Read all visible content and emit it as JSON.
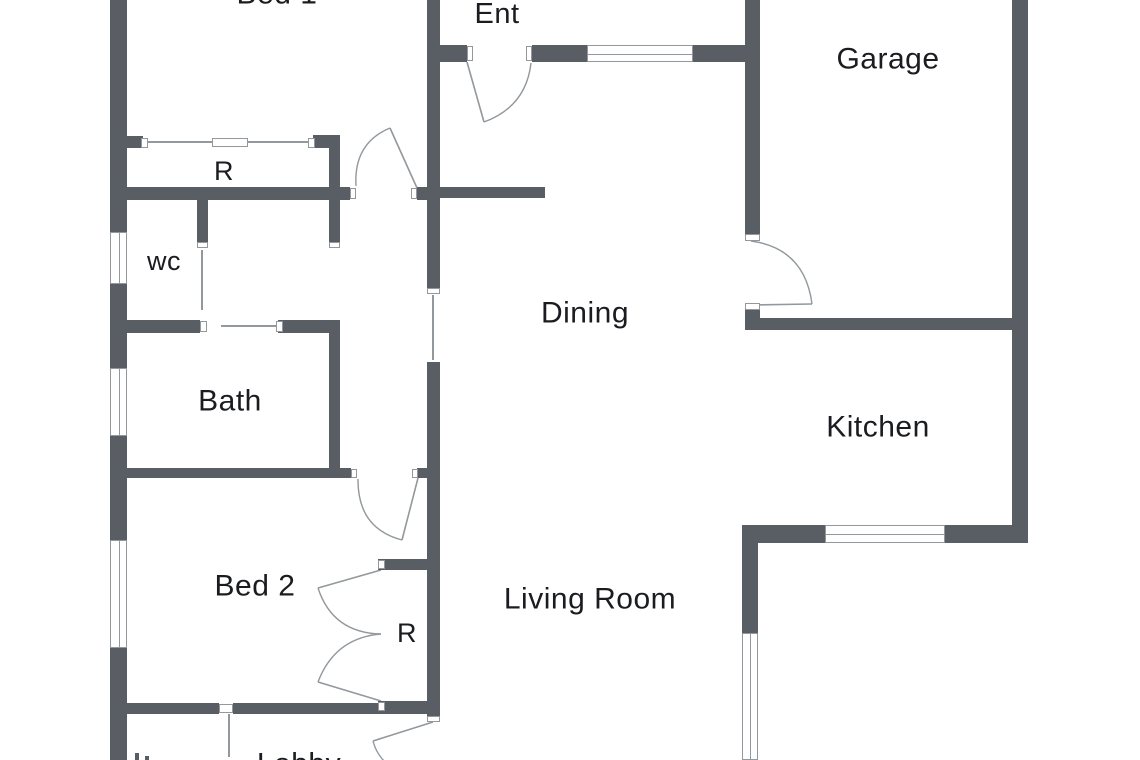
{
  "meta": {
    "type": "floor-plan",
    "description": "Single storey house floor plan"
  },
  "colors": {
    "wall": "#585e64",
    "line": "#92989c",
    "text": "#1b1c20",
    "bg": "#ffffff",
    "window_fill": "#ffffff"
  },
  "labels": [
    {
      "id": "bed1",
      "text": "Bed 1",
      "x": 277,
      "y": -6,
      "size": 30
    },
    {
      "id": "ent",
      "text": "Ent",
      "x": 497,
      "y": 15,
      "size": 29
    },
    {
      "id": "garage",
      "text": "Garage",
      "x": 888,
      "y": 59,
      "size": 30
    },
    {
      "id": "closet-r-top",
      "text": "R",
      "x": 224,
      "y": 172,
      "size": 27
    },
    {
      "id": "wc",
      "text": "wc",
      "x": 164,
      "y": 262,
      "size": 27
    },
    {
      "id": "dining",
      "text": "Dining",
      "x": 585,
      "y": 313,
      "size": 30
    },
    {
      "id": "bath",
      "text": "Bath",
      "x": 230,
      "y": 401,
      "size": 30
    },
    {
      "id": "kitchen",
      "text": "Kitchen",
      "x": 878,
      "y": 427,
      "size": 30
    },
    {
      "id": "bed2",
      "text": "Bed 2",
      "x": 255,
      "y": 586,
      "size": 30
    },
    {
      "id": "closet-r-bed2",
      "text": "R",
      "x": 407,
      "y": 634,
      "size": 27
    },
    {
      "id": "living-room",
      "text": "Living Room",
      "x": 590,
      "y": 599,
      "size": 30
    },
    {
      "id": "lobby",
      "text": "Lobby",
      "x": 299,
      "y": 764,
      "size": 30
    }
  ],
  "walls": [
    [
      110,
      0,
      17,
      232
    ],
    [
      110,
      284,
      17,
      84
    ],
    [
      110,
      436,
      17,
      104
    ],
    [
      110,
      648,
      17,
      112
    ],
    [
      427,
      0,
      13,
      290
    ],
    [
      427,
      362,
      13,
      356
    ],
    [
      440,
      45,
      27,
      17
    ],
    [
      532,
      45,
      55,
      17
    ],
    [
      693,
      45,
      52,
      17
    ],
    [
      745,
      0,
      15,
      241
    ],
    [
      745,
      303,
      15,
      27
    ],
    [
      745,
      318,
      267,
      12
    ],
    [
      1012,
      0,
      16,
      543
    ],
    [
      110,
      187,
      240,
      13
    ],
    [
      417,
      187,
      10,
      13
    ],
    [
      440,
      187,
      105,
      11
    ],
    [
      197,
      193,
      11,
      50
    ],
    [
      329,
      135,
      11,
      108
    ],
    [
      313,
      135,
      27,
      13
    ],
    [
      127,
      136,
      16,
      12
    ],
    [
      110,
      320,
      90,
      13
    ],
    [
      278,
      320,
      62,
      13
    ],
    [
      329,
      333,
      11,
      135
    ],
    [
      110,
      468,
      241,
      10
    ],
    [
      417,
      468,
      11,
      10
    ],
    [
      110,
      703,
      109,
      11
    ],
    [
      233,
      703,
      207,
      11
    ],
    [
      378,
      559,
      62,
      11
    ],
    [
      378,
      701,
      62,
      11
    ],
    [
      742,
      525,
      83,
      18
    ],
    [
      945,
      525,
      83,
      18
    ],
    [
      742,
      525,
      16,
      108
    ]
  ],
  "caps": [
    [
      350,
      188,
      6,
      11
    ],
    [
      411,
      188,
      6,
      11
    ],
    [
      467,
      46,
      6,
      15
    ],
    [
      526,
      46,
      6,
      15
    ],
    [
      745,
      234,
      15,
      7
    ],
    [
      745,
      303,
      15,
      7
    ],
    [
      351,
      469,
      6,
      9
    ],
    [
      412,
      469,
      6,
      9
    ],
    [
      427,
      288,
      13,
      6
    ],
    [
      427,
      716,
      13,
      6
    ],
    [
      378,
      560,
      7,
      9
    ],
    [
      378,
      702,
      7,
      9
    ],
    [
      219,
      704,
      14,
      9
    ],
    [
      197,
      242,
      11,
      6
    ],
    [
      329,
      242,
      11,
      6
    ],
    [
      200,
      321,
      7,
      11
    ],
    [
      276,
      321,
      7,
      11
    ],
    [
      141,
      138,
      7,
      10
    ],
    [
      308,
      138,
      7,
      10
    ]
  ],
  "windows": [
    {
      "rect": [
        110,
        232,
        17,
        52
      ],
      "orient": "v",
      "name": "wc-window"
    },
    {
      "rect": [
        110,
        368,
        17,
        68
      ],
      "orient": "v",
      "name": "bath-window"
    },
    {
      "rect": [
        110,
        540,
        17,
        108
      ],
      "orient": "v",
      "name": "bed2-window"
    },
    {
      "rect": [
        587,
        45,
        106,
        17
      ],
      "orient": "h",
      "name": "ent-window"
    },
    {
      "rect": [
        825,
        525,
        120,
        18
      ],
      "orient": "h",
      "name": "kitchen-window"
    },
    {
      "rect": [
        742,
        633,
        16,
        127
      ],
      "orient": "v",
      "name": "living-room-window"
    }
  ],
  "sliding_overlap": [
    [
      212,
      138,
      36,
      9
    ]
  ],
  "thin_lines": [
    [
      148,
      142,
      313,
      142
    ],
    [
      202,
      250,
      202,
      310
    ],
    [
      221,
      326,
      281,
      326
    ],
    [
      433,
      295,
      433,
      360
    ],
    [
      229,
      714,
      229,
      757
    ]
  ],
  "doors": [
    {
      "name": "ent-door",
      "hinge": [
        467,
        62
      ],
      "tip": [
        484,
        122
      ],
      "end": [
        531,
        63
      ]
    },
    {
      "name": "hall-dining-door",
      "hinge": [
        417,
        188
      ],
      "tip": [
        390,
        128
      ],
      "end": [
        356,
        186
      ]
    },
    {
      "name": "dining-garage-door",
      "hinge": [
        750,
        305
      ],
      "tip": [
        812,
        304
      ],
      "end": [
        751,
        241
      ]
    },
    {
      "name": "bed2-door",
      "hinge": [
        418,
        478
      ],
      "tip": [
        402,
        540
      ],
      "end": [
        358,
        479
      ]
    },
    {
      "name": "closet-door-upper",
      "hinge": [
        381,
        570
      ],
      "tip": [
        318,
        588
      ],
      "end": [
        381,
        634
      ]
    },
    {
      "name": "closet-door-lower",
      "hinge": [
        381,
        701
      ],
      "tip": [
        318,
        682
      ],
      "end": [
        381,
        634
      ]
    },
    {
      "name": "lobby-door",
      "hinge": [
        433,
        722
      ],
      "tip": [
        373,
        741
      ],
      "end": [
        396,
        770
      ]
    }
  ],
  "marks": [
    [
      135,
      753,
      4,
      7
    ],
    [
      145,
      756,
      4,
      4
    ]
  ]
}
